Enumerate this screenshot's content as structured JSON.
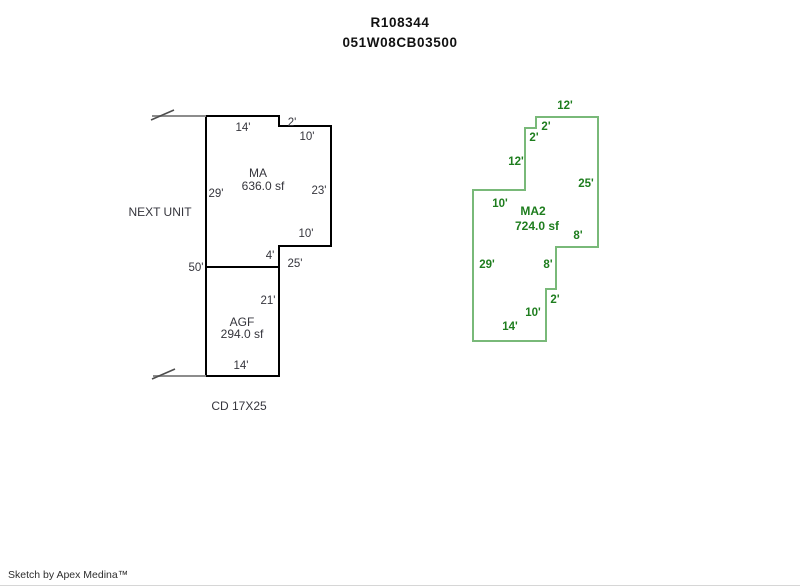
{
  "header": {
    "record_id": "R108344",
    "parcel_id": "051W08CB03500"
  },
  "annotations": {
    "next_unit": "NEXT UNIT",
    "condition": "CD 17X25"
  },
  "footer": {
    "credit": "Sketch by Apex Medina™"
  },
  "areas": {
    "ma": {
      "code": "MA",
      "size": "636.0 sf",
      "area_sf": 636.0
    },
    "agf": {
      "code": "AGF",
      "size": "294.0 sf",
      "area_sf": 294.0
    },
    "ma2": {
      "code": "MA2",
      "size": "724.0 sf",
      "area_sf": 724.0
    }
  },
  "colors": {
    "black_line": "#000000",
    "black_text": "#35353c",
    "green_line": "#79b979",
    "green_text": "#1e7d1e",
    "arrow_gray": "#8c8c8c",
    "arrow_dark": "#4d4d4d"
  },
  "diagram": {
    "shapes": [
      {
        "name": "ma-outline",
        "color": "black_line",
        "stroke_width": 2,
        "closed": true,
        "points": [
          [
            206,
            116
          ],
          [
            279,
            116
          ],
          [
            279,
            126
          ],
          [
            331,
            126
          ],
          [
            331,
            246
          ],
          [
            279,
            246
          ],
          [
            279,
            267
          ],
          [
            206,
            267
          ]
        ]
      },
      {
        "name": "agf-outline",
        "color": "black_line",
        "stroke_width": 2,
        "closed": true,
        "points": [
          [
            206,
            267
          ],
          [
            279,
            267
          ],
          [
            279,
            376
          ],
          [
            206,
            376
          ]
        ]
      },
      {
        "name": "ma2-outline",
        "color": "green_line",
        "stroke_width": 2,
        "closed": true,
        "points": [
          [
            536,
            117
          ],
          [
            598,
            117
          ],
          [
            598,
            247
          ],
          [
            556,
            247
          ],
          [
            556,
            289
          ],
          [
            546,
            289
          ],
          [
            546,
            341
          ],
          [
            473,
            341
          ],
          [
            473,
            190
          ],
          [
            525,
            190
          ],
          [
            525,
            128
          ],
          [
            536,
            128
          ]
        ]
      },
      {
        "name": "top-arrow-line",
        "color": "arrow_gray",
        "stroke_width": 2,
        "closed": false,
        "points": [
          [
            152,
            116
          ],
          [
            206,
            116
          ]
        ]
      },
      {
        "name": "top-arrow-tick",
        "color": "arrow_dark",
        "stroke_width": 1.5,
        "closed": false,
        "points": [
          [
            151,
            120
          ],
          [
            174,
            110
          ]
        ]
      },
      {
        "name": "bottom-arrow-line",
        "color": "arrow_gray",
        "stroke_width": 2,
        "closed": false,
        "points": [
          [
            153,
            376
          ],
          [
            206,
            376
          ]
        ]
      },
      {
        "name": "bottom-arrow-tick",
        "color": "arrow_dark",
        "stroke_width": 1.5,
        "closed": false,
        "points": [
          [
            152,
            379
          ],
          [
            175,
            369
          ]
        ]
      }
    ],
    "label_groups": [
      {
        "name": "black-dimension",
        "color": "black_text",
        "bold": false,
        "font_size": 11.5,
        "items": [
          {
            "text": "14'",
            "x": 243,
            "y": 128
          },
          {
            "text": "2'",
            "x": 292,
            "y": 123
          },
          {
            "text": "10'",
            "x": 307,
            "y": 137
          },
          {
            "text": "29'",
            "x": 216,
            "y": 194
          },
          {
            "text": "23'",
            "x": 319,
            "y": 191
          },
          {
            "text": "10'",
            "x": 306,
            "y": 234
          },
          {
            "text": "4'",
            "x": 270,
            "y": 256
          },
          {
            "text": "50'",
            "x": 196,
            "y": 268
          },
          {
            "text": "25'",
            "x": 295,
            "y": 264
          },
          {
            "text": "21'",
            "x": 268,
            "y": 301
          },
          {
            "text": "14'",
            "x": 241,
            "y": 366
          }
        ]
      },
      {
        "name": "green-dimension",
        "color": "green_text",
        "bold": true,
        "font_size": 11.5,
        "items": [
          {
            "text": "12'",
            "x": 565,
            "y": 106
          },
          {
            "text": "2'",
            "x": 546,
            "y": 127
          },
          {
            "text": "2'",
            "x": 534,
            "y": 138
          },
          {
            "text": "12'",
            "x": 516,
            "y": 162
          },
          {
            "text": "25'",
            "x": 586,
            "y": 184
          },
          {
            "text": "10'",
            "x": 500,
            "y": 204
          },
          {
            "text": "8'",
            "x": 578,
            "y": 236
          },
          {
            "text": "29'",
            "x": 487,
            "y": 265
          },
          {
            "text": "8'",
            "x": 548,
            "y": 265
          },
          {
            "text": "2'",
            "x": 555,
            "y": 300
          },
          {
            "text": "10'",
            "x": 533,
            "y": 313
          },
          {
            "text": "14'",
            "x": 510,
            "y": 327
          }
        ]
      }
    ]
  }
}
